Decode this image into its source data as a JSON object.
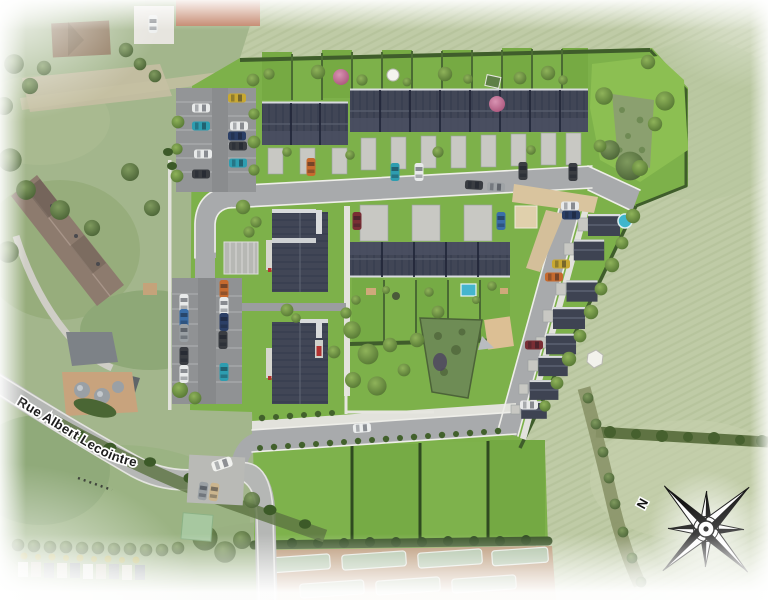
{
  "scene": {
    "description": "3D aerial render of a new residential development inserted into an aerial photo",
    "street_label": "Rue Albert Lecointre",
    "compass": {
      "north_label": "N",
      "icon": "compass-rose-icon",
      "points": 8,
      "rotation_deg": -44
    }
  },
  "palette": {
    "dev_lawn": "#7db14a",
    "crop_field": "#bfcba6",
    "crop_row_line": "#aebd93",
    "aerial_grass": "#a3b68c",
    "road": "#a8aaac",
    "street": "#b5b7b5",
    "sidewalk": "#e2e2dc",
    "roof_slate": "#3e4352",
    "roof_ridge": "#5a6070",
    "driveway": "#c8c8c3",
    "parking": "#909294",
    "hedge": "#3c5a28",
    "sand_path": "#d9c49e",
    "soil": "#b5906d",
    "pool_blue": "#45b5cd",
    "tree_green": "#4a6b2c",
    "tree_pink": "#a34a72",
    "compass_ink": "#161616"
  }
}
